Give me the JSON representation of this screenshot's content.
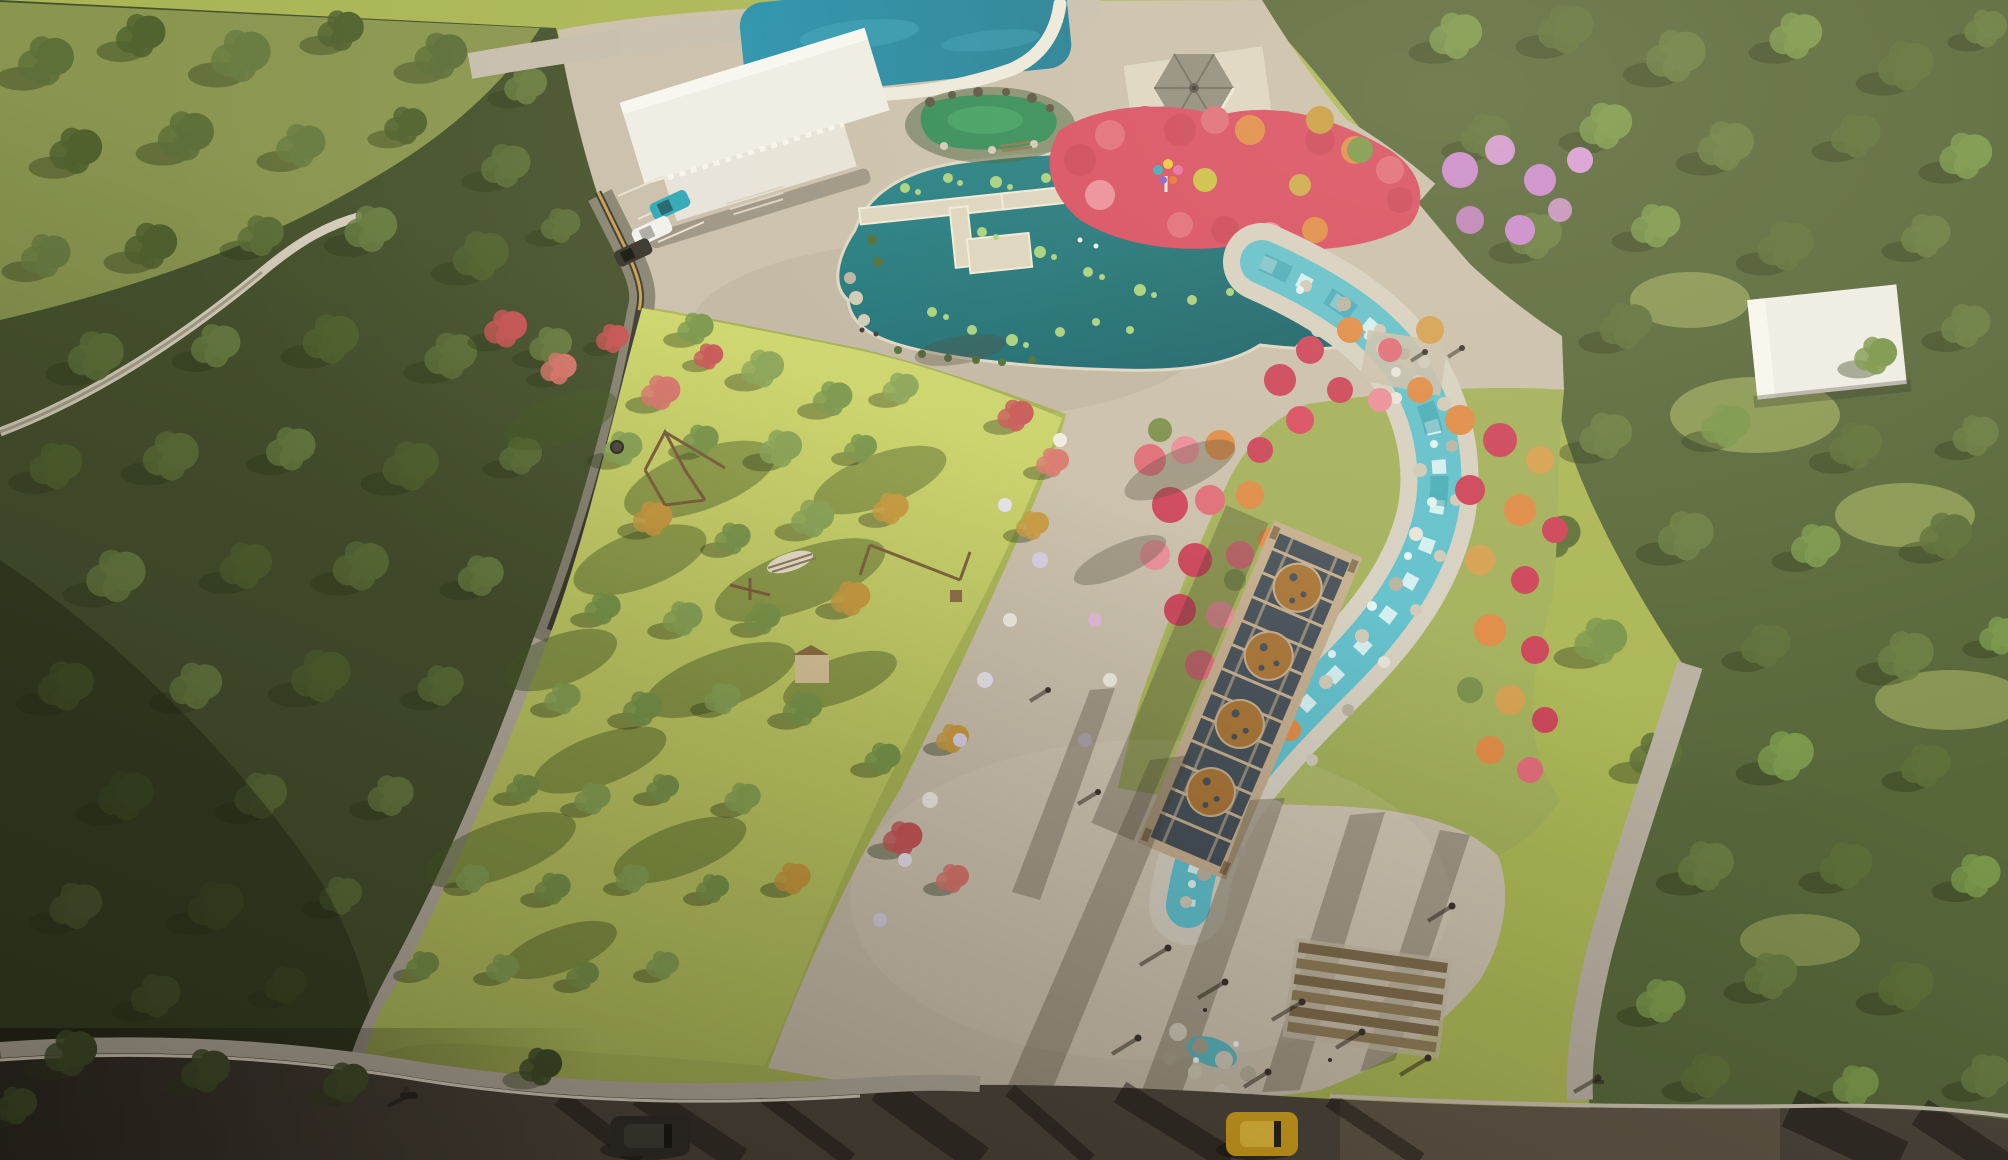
{
  "scene": {
    "type": "aerial-architectural-rendering",
    "description": "Bird's-eye architectural rendering of a park: a lotus pond with a zig-zag boardwalk, a swimming pool beside a white visitor building with a small parking lot, a Chinese pavilion above a red azalea garden with a colorful sculpture, a winding turquoise rocky stream lined with red, pink and orange flowering trees, a sunlit central lawn with a rope playground, a hammock and a long trellis pergola with round ornamental medallions, dense perimeter forests, an entrance plaza with pedestrians and timber steps, and a shaded road with cars along the bottom edge.",
    "elements": [
      {
        "name": "left-forest",
        "label": "dense shaded forest belt"
      },
      {
        "name": "topleft-meadow",
        "label": "light meadow corner with footpath trail"
      },
      {
        "name": "right-forest",
        "label": "sunlit forest with clearing and trail"
      },
      {
        "name": "swimming-pool",
        "label": "deep blue pool with white curved deck"
      },
      {
        "name": "visitor-building",
        "label": "white flat-roofed building complex"
      },
      {
        "name": "parking-lot",
        "label": "three parked cars (teal, white, dark)"
      },
      {
        "name": "lotus-pond",
        "label": "teal pond with lily pads and boardwalk"
      },
      {
        "name": "green-pond",
        "label": "small green rock-edged pool"
      },
      {
        "name": "chinese-pavilion",
        "label": "hexagonal gray-roofed gazebo"
      },
      {
        "name": "azalea-garden",
        "label": "masses of red and pink azaleas with peacock sculpture"
      },
      {
        "name": "stream",
        "label": "winding turquoise stream with white rocky banks"
      },
      {
        "name": "lawn-meadow",
        "label": "bright lawn with scattered green, gold and red trees"
      },
      {
        "name": "playground",
        "label": "timber rope-course and playhouse"
      },
      {
        "name": "pergola-trellis",
        "label": "diagonal trellis with four rust medallions"
      },
      {
        "name": "entrance-plaza",
        "label": "paved plaza with pedestrians and long shadows"
      },
      {
        "name": "timber-steps",
        "label": "wood deck steps by stream outlet"
      },
      {
        "name": "road",
        "label": "shaded asphalt road with SUV, yellow taxi, motorcycle and cyclist"
      }
    ],
    "colors": {
      "lawn": "#b4c05c",
      "lawnBright": "#cdd66b",
      "meadowCorner": "#8e9a52",
      "forestLeft": "#46522e",
      "forestRight": "#57673a",
      "treeDark": "#51632f",
      "treeMid": "#5d7038",
      "treeLight": "#687c41",
      "treeSun1": "#79964a",
      "treeSun2": "#88a455",
      "treeGold": "#c89a3e",
      "fTreeRed": "#c75555",
      "fTreeCoral": "#d8766c",
      "flowerRed": "#cc4258",
      "flowerCoral": "#e06a78",
      "flowerPinkLight": "#ea8c98",
      "flowerOrange": "#e08a45",
      "flowerAmber": "#d4a050",
      "flowerMagenta": "#d84a60",
      "flowerPurple": "#c988cf",
      "path": "#c9bfac",
      "pathLight": "#d8cfbc",
      "sidewalk": "#b6ae9f",
      "pondDeep": "#0f5a63",
      "pondLight": "#1d8087",
      "pool": "#1b7b94",
      "stream": "#5fc0cd",
      "streamBank": "#d6d0c2",
      "greenPond": "#2e8a55",
      "lily": "#a6d17a",
      "building": "#efede6",
      "roof": "#8e897d",
      "deckWhite": "#eceade",
      "pergolaFrame": "#c3ad8e",
      "pergolaPanel": "#454f58",
      "medallion": "#a87436",
      "road": "#4c453a",
      "curb": "#ded6c4",
      "rock": "#cfc9b8",
      "carTeal": "#2aa7b8",
      "carWhite": "#f2f1ed",
      "carDark": "#35322b",
      "suv": "#2e2b26",
      "taxi": "#d9a61e",
      "timber": "#7d6a4a"
    }
  }
}
